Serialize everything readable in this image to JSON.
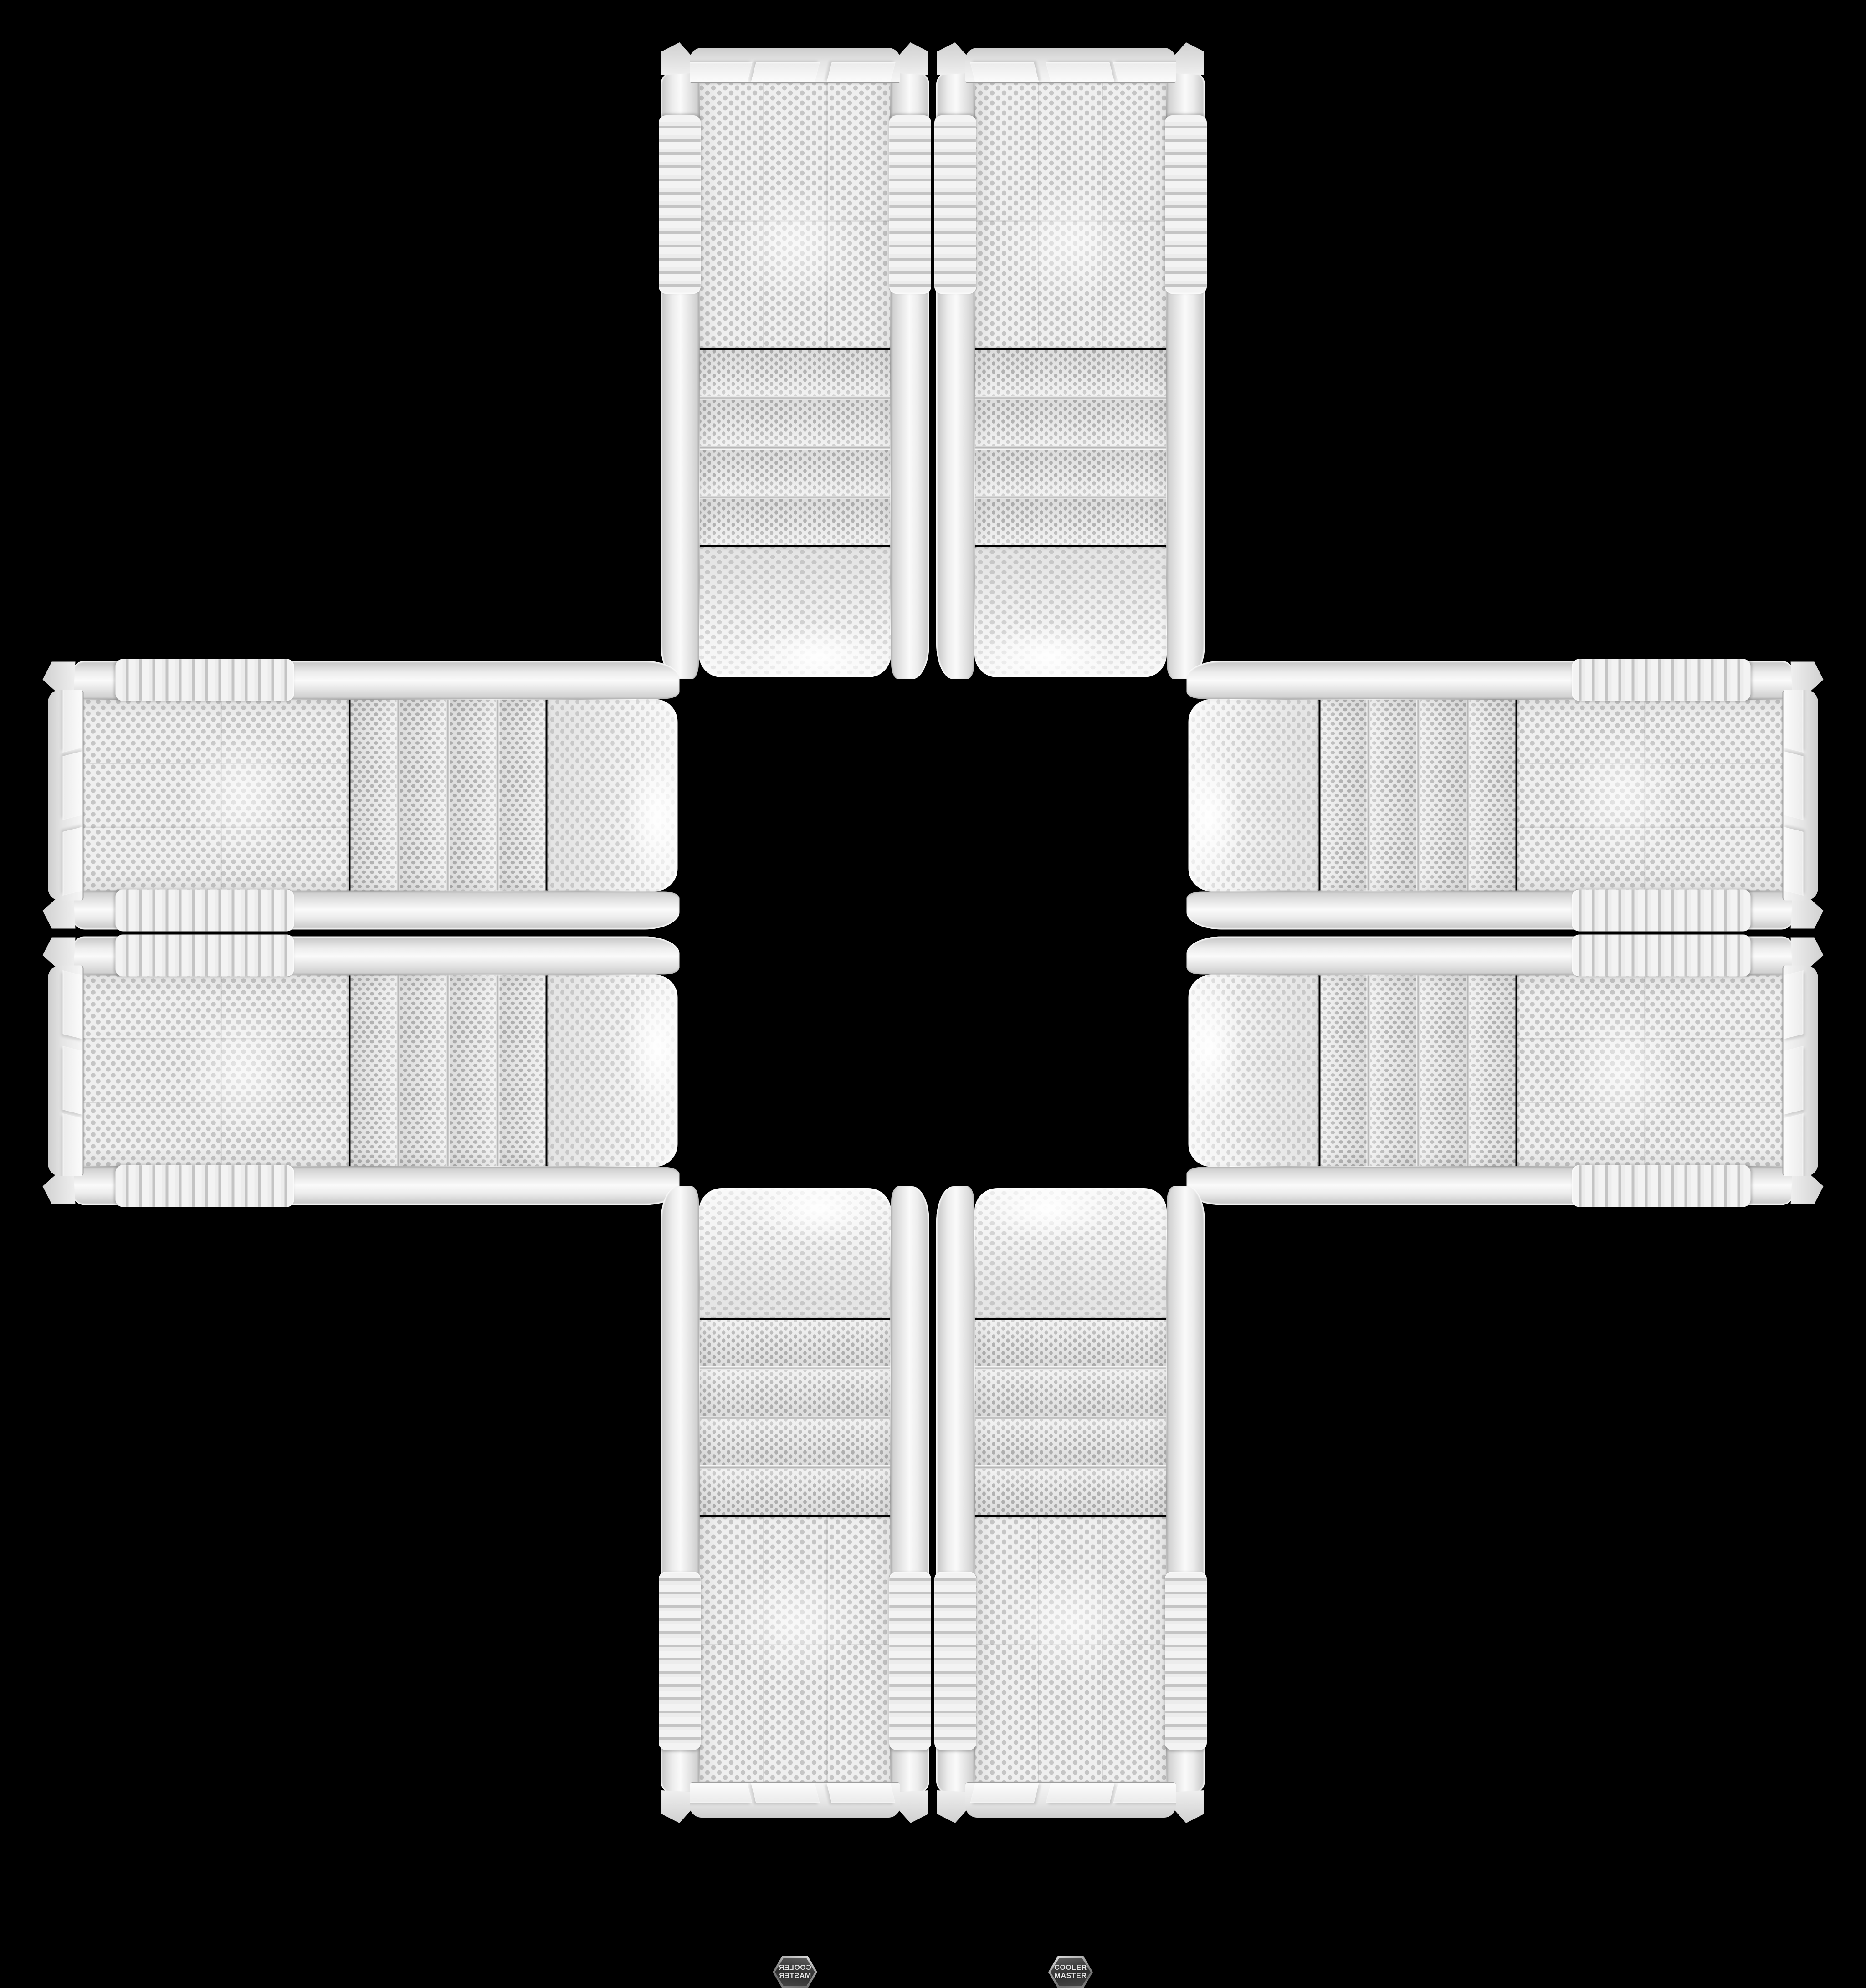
{
  "scene": {
    "background_color": "#000000",
    "case_count": 8
  },
  "badge": {
    "line1": "COOLER",
    "line2": "MASTER"
  },
  "colors": {
    "case_body_white": "#f1f1f1",
    "mesh_holes_gray": "#bdbdbd",
    "badge_dark": "#3a3a3a",
    "chrome_trim": "#b0b0b0",
    "background": "#000000"
  }
}
